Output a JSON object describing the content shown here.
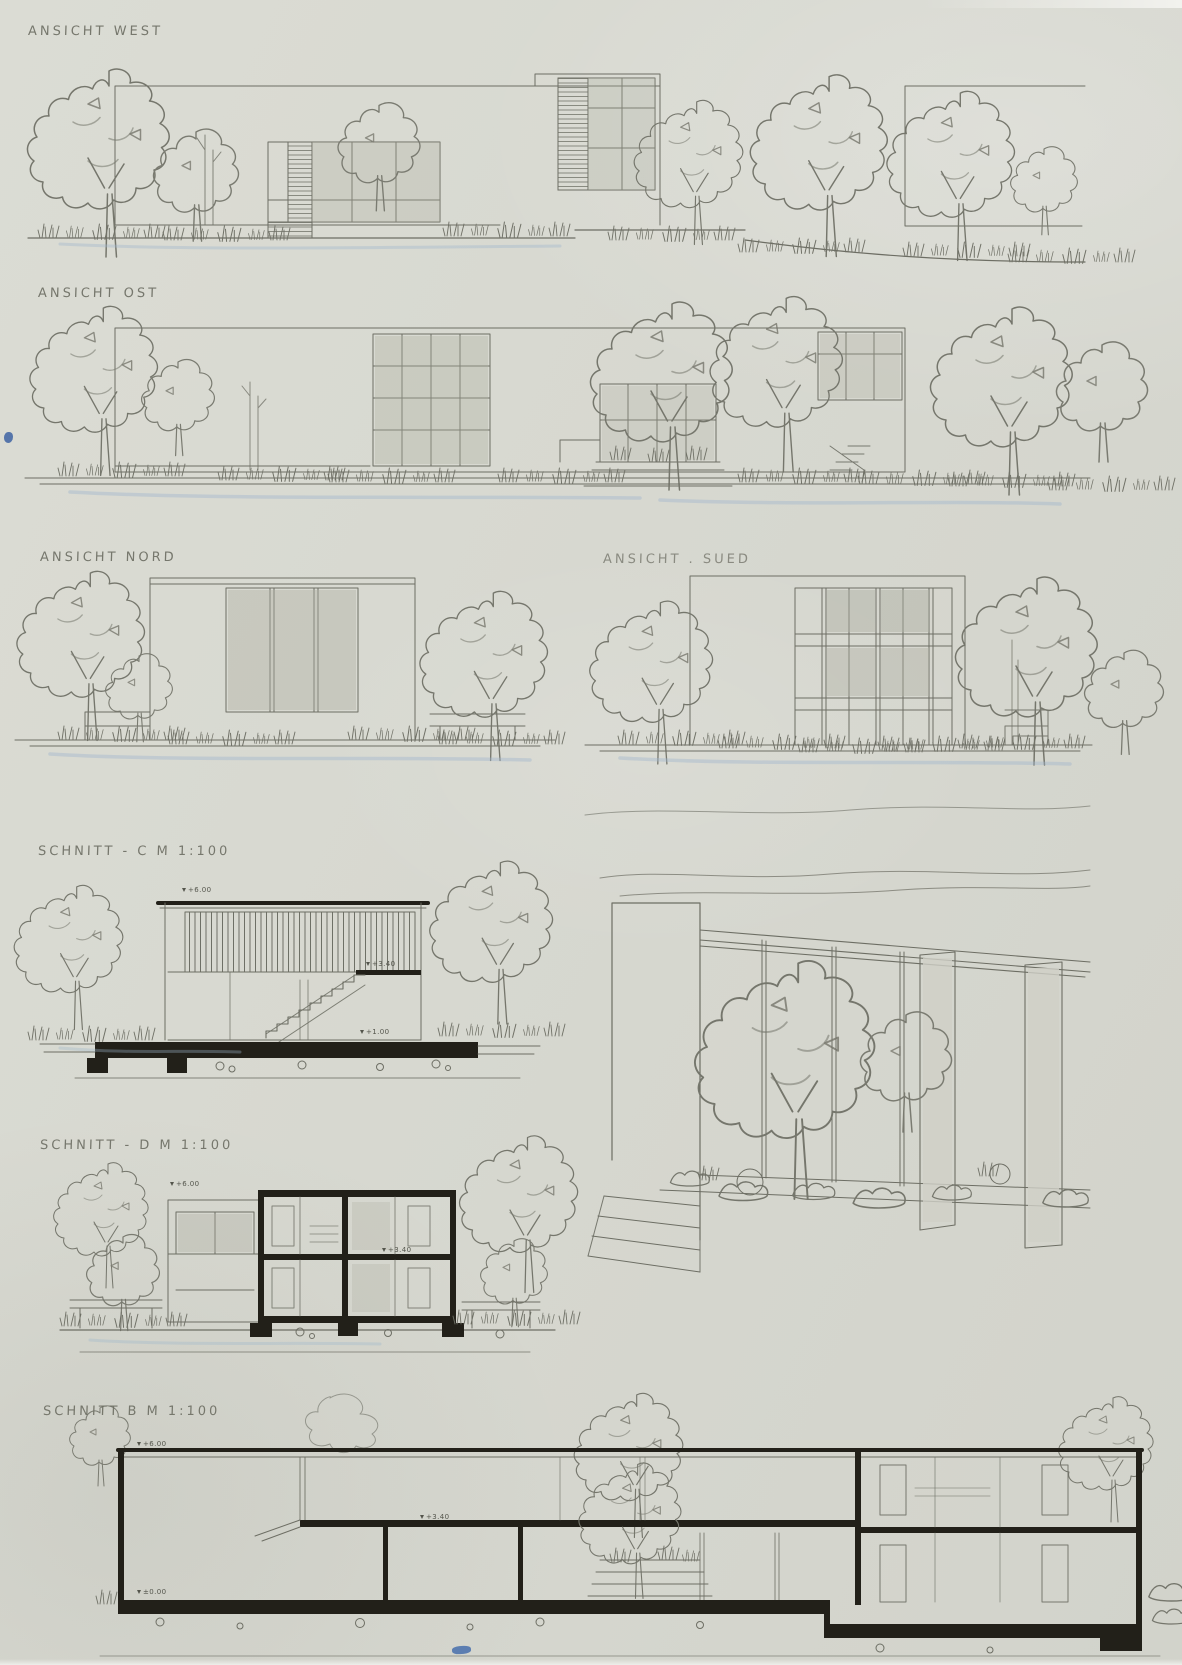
{
  "labels": {
    "west": "ANSICHT WEST",
    "ost": "ANSICHT OST",
    "nord": "ANSICHT NORD",
    "sued": "ANSICHT . SUED",
    "schnitt_c": "SCHNITT - C  M 1:100",
    "schnitt_d": "SCHNITT - D  M 1:100",
    "schnitt_b": "SCHNITT B  M 1:100"
  },
  "annotations": {
    "c_top": "+6.00",
    "c_mid": "+3.40",
    "c_low": "+1.00",
    "d_top": "+6.00",
    "d_mid": "+3.40",
    "b_top": "+6.00",
    "b_mid": "+3.40",
    "b_zero": "±0.00"
  },
  "palette": {
    "paper": "#d7d8d0",
    "pencil": "#6d6e64",
    "ink": "#222019",
    "graphite_shade": "#aeb0a2",
    "watercolor_blue": "#9fb6cc",
    "pin_blue": "#3d63a2"
  }
}
